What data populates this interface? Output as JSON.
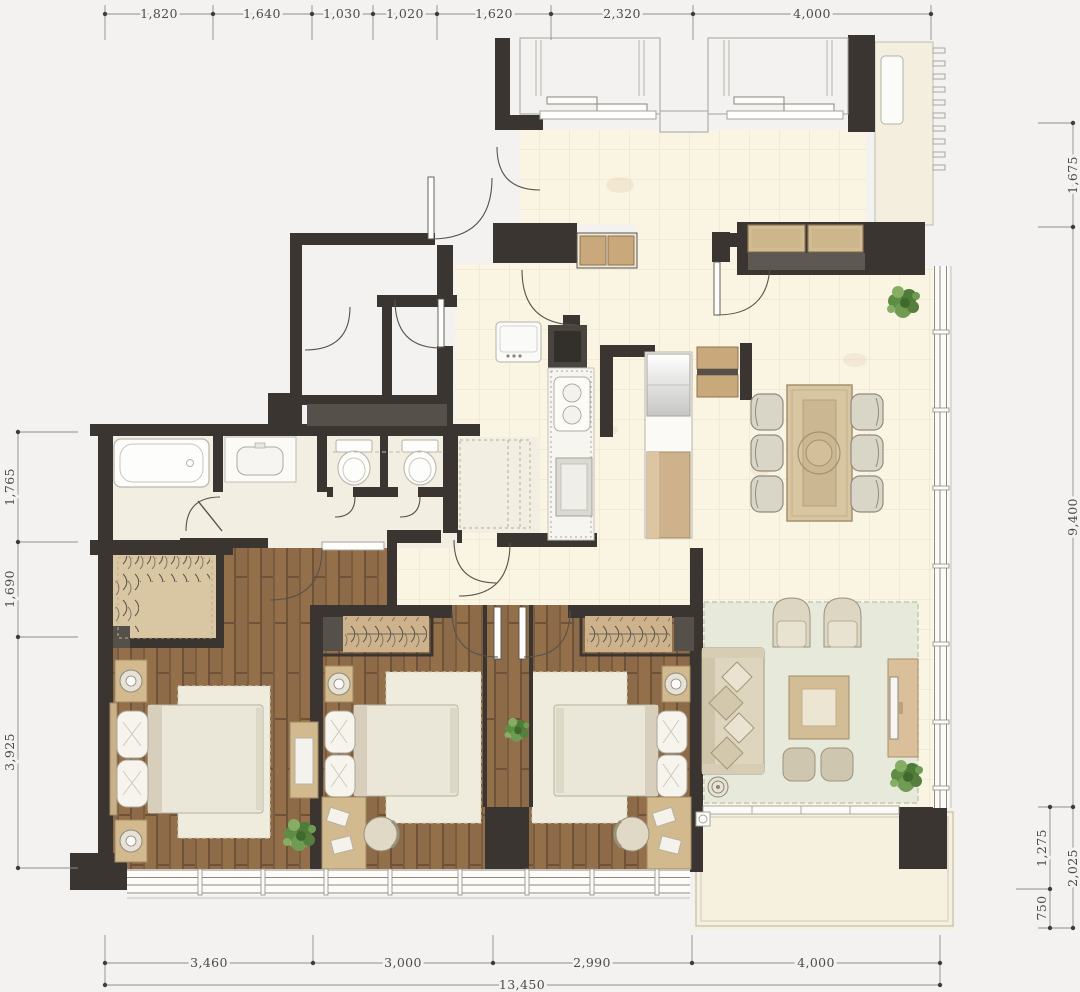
{
  "palette": {
    "background": "#f4f2f1",
    "wall": "#3a3531",
    "wood_floor": "#8a6947",
    "tile_floor": "#faf4e3",
    "tile_line": "#ebe0ca",
    "closet_tan": "#d9c6a2",
    "cabinet_tan": "#cdb28b",
    "cushion_tan": "#d3bb93",
    "dark_furniture": "#55504a",
    "rug_sage": "#e7e9db",
    "rug_cream": "#efecdd",
    "fixture_white": "#fdfdfb",
    "plant_green": "#4e7b38",
    "balcony_cream": "#f6f0df"
  },
  "icons": {
    "plant": "potted-plant-icon",
    "lamp": "table-lamp-icon",
    "door_swing": "quarter-arc-door-icon",
    "dimension_marker": "tick-and-dot-icon"
  },
  "dimensions": {
    "top": [
      "1,820",
      "1,640",
      "1,030",
      "1,020",
      "1,620",
      "2,320",
      "4,000"
    ],
    "right": [
      "1,675",
      "9,400"
    ],
    "right_bottom": [
      "1,275",
      "750"
    ],
    "right_bottom_total": "2,025",
    "left": [
      "1,765",
      "1,690",
      "3,925"
    ],
    "bottom": [
      "3,460",
      "3,000",
      "2,990",
      "4,000"
    ],
    "bottom_total": "13,450"
  }
}
